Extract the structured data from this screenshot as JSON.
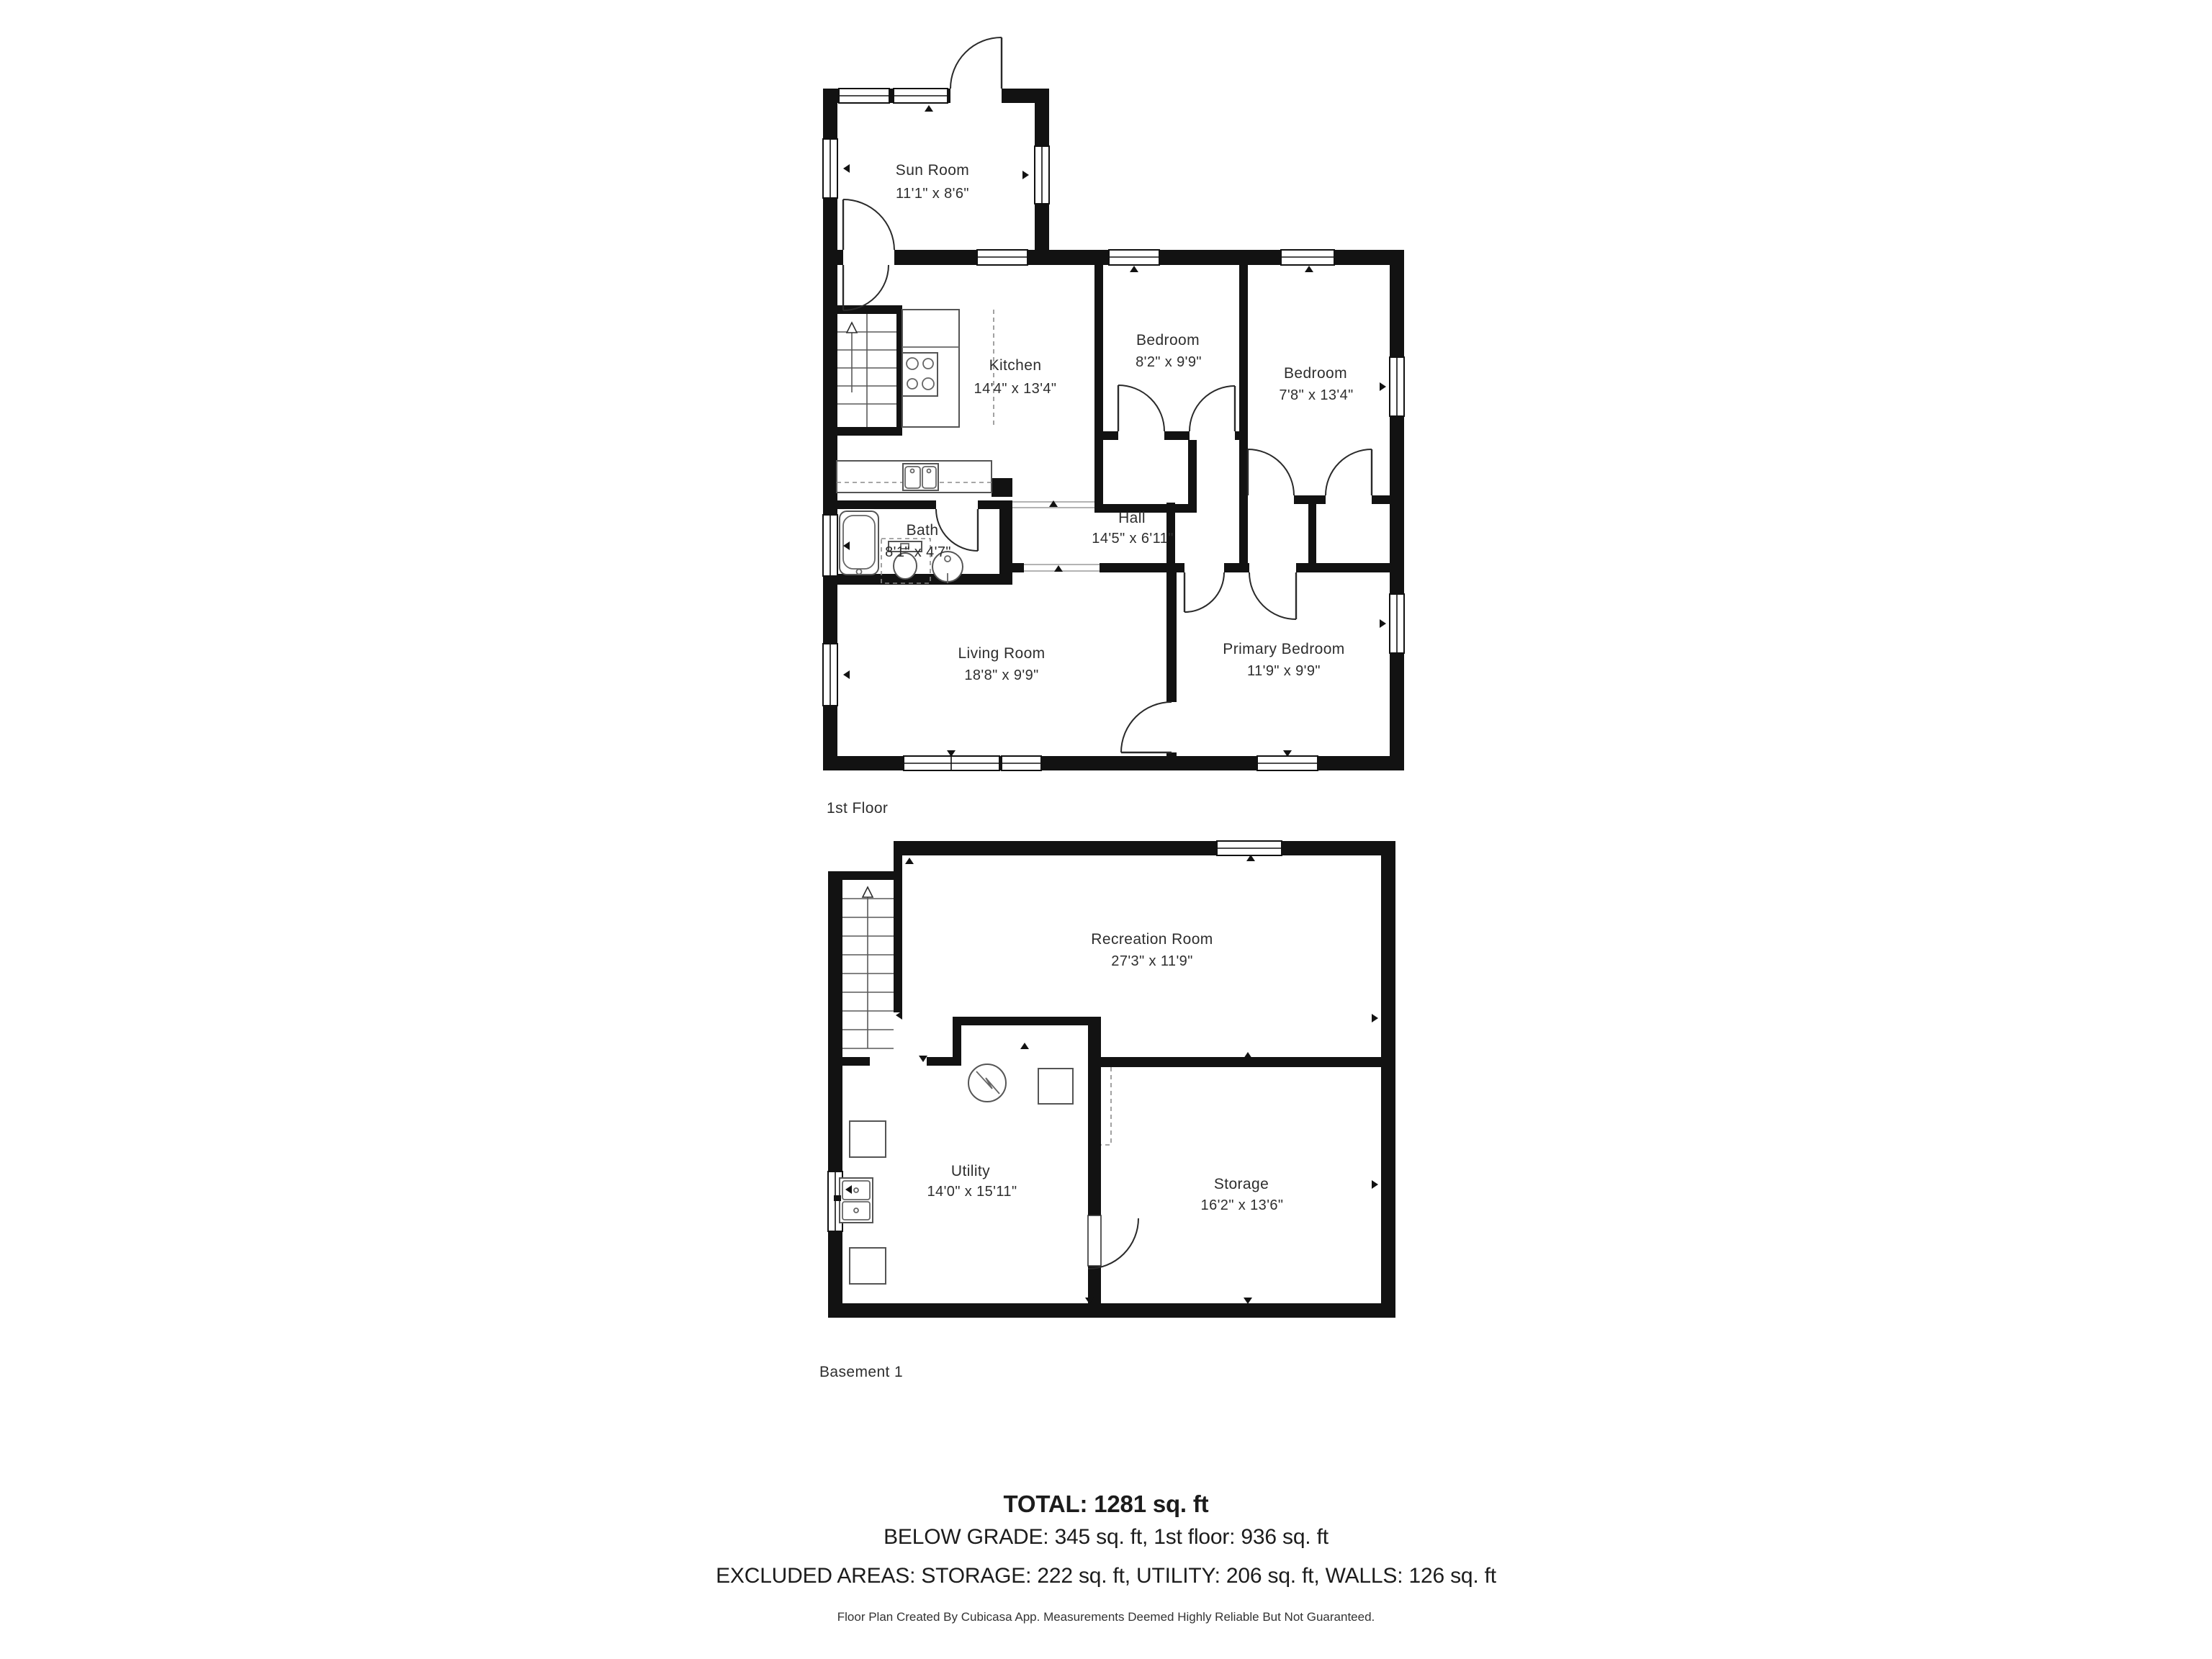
{
  "page": {
    "background": "#ffffff",
    "type": "floor-plan"
  },
  "floors": [
    {
      "label": "1st Floor",
      "rooms": [
        {
          "name": "Sun Room",
          "dims": "11'1\" x 8'6\""
        },
        {
          "name": "Kitchen",
          "dims": "14'4\" x 13'4\""
        },
        {
          "name": "Bedroom",
          "dims": "8'2\" x 9'9\""
        },
        {
          "name": "Bedroom",
          "dims": "7'8\" x 13'4\""
        },
        {
          "name": "Hall",
          "dims": "14'5\" x 6'11\""
        },
        {
          "name": "Bath",
          "dims": "8'1\" x 4'7\""
        },
        {
          "name": "Living Room",
          "dims": "18'8\" x 9'9\""
        },
        {
          "name": "Primary Bedroom",
          "dims": "11'9\" x 9'9\""
        }
      ]
    },
    {
      "label": "Basement 1",
      "rooms": [
        {
          "name": "Recreation Room",
          "dims": "27'3\" x 11'9\""
        },
        {
          "name": "Utility",
          "dims": "14'0\" x 15'11\""
        },
        {
          "name": "Storage",
          "dims": "16'2\" x 13'6\""
        }
      ]
    }
  ],
  "summary": {
    "total": "TOTAL: 1281 sq. ft",
    "line2": "BELOW GRADE: 345 sq. ft, 1st floor: 936 sq. ft",
    "line3": "EXCLUDED AREAS: STORAGE: 222 sq. ft, UTILITY: 206 sq. ft, WALLS: 126 sq. ft"
  },
  "footer": {
    "disclaimer": "Floor Plan Created By Cubicasa App. Measurements Deemed Highly Reliable But Not Guaranteed."
  },
  "legend": {
    "fixtures": [
      "staircase-up-arrow",
      "stove-burners",
      "kitchen-sink",
      "bathtub",
      "toilet",
      "pedestal-sink",
      "water-heater",
      "laundry-sink",
      "appliance-square"
    ]
  },
  "colors": {
    "wall": "#121212",
    "label_text": "#2e2e2e",
    "fixture_stroke": "#555555"
  }
}
